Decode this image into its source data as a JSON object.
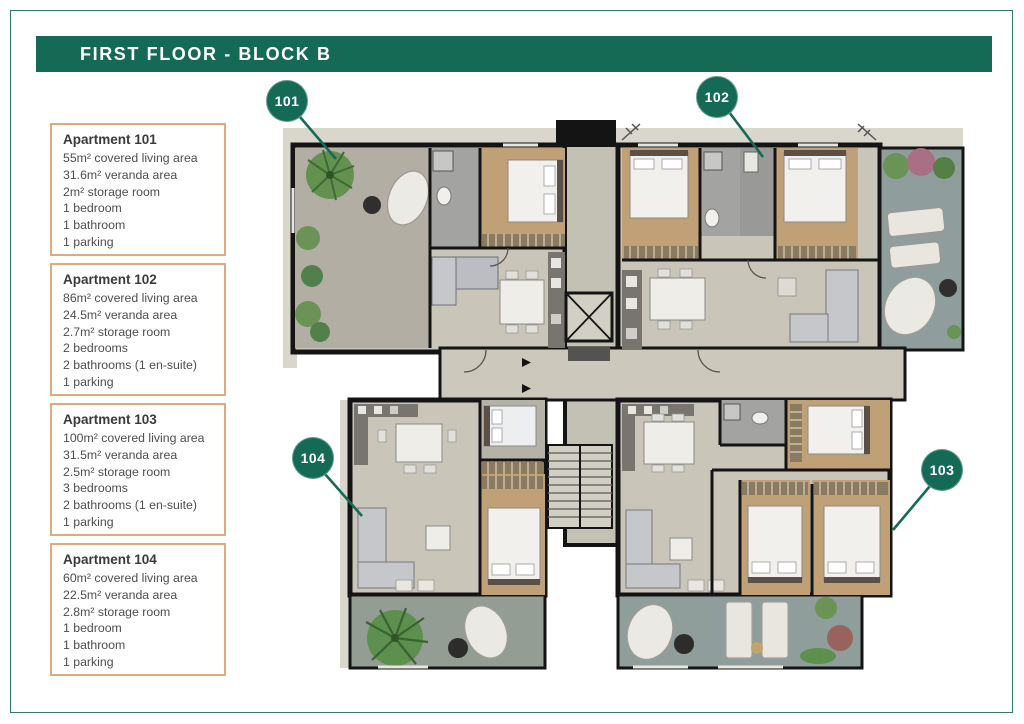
{
  "header": {
    "title": "FIRST FLOOR - BLOCK B"
  },
  "apartments": [
    {
      "title": "Apartment 101",
      "lines": [
        "55m² covered living area",
        "31.6m² veranda area",
        "2m² storage room",
        "1 bedroom",
        "1 bathroom",
        "1 parking"
      ]
    },
    {
      "title": "Apartment 102",
      "lines": [
        "86m² covered living area",
        "24.5m² veranda area",
        "2.7m² storage room",
        "2 bedrooms",
        "2 bathrooms (1 en-suite)",
        "1 parking"
      ]
    },
    {
      "title": "Apartment 103",
      "lines": [
        "100m² covered living area",
        "31.5m² veranda area",
        "2.5m² storage room",
        "3 bedrooms",
        "2 bathrooms (1 en-suite)",
        "1 parking"
      ]
    },
    {
      "title": "Apartment 104",
      "lines": [
        "60m² covered living area",
        "22.5m² veranda area",
        "2.8m² storage room",
        "1 bedroom",
        "1 bathroom",
        "1 parking"
      ]
    }
  ],
  "plan": {
    "badges": [
      {
        "label": "101"
      },
      {
        "label": "102"
      },
      {
        "label": "103"
      },
      {
        "label": "104"
      }
    ]
  },
  "colors": {
    "brand_green": "#156a56",
    "card_border": "#dcab7e",
    "wall_black": "#141414",
    "floor_gray": "#c9c5b8",
    "veranda_gray": "#b2aea3",
    "veranda_blue": "#8f9d9d",
    "wood_floor": "#bfa077",
    "plant_green": "#5d8f4e"
  }
}
